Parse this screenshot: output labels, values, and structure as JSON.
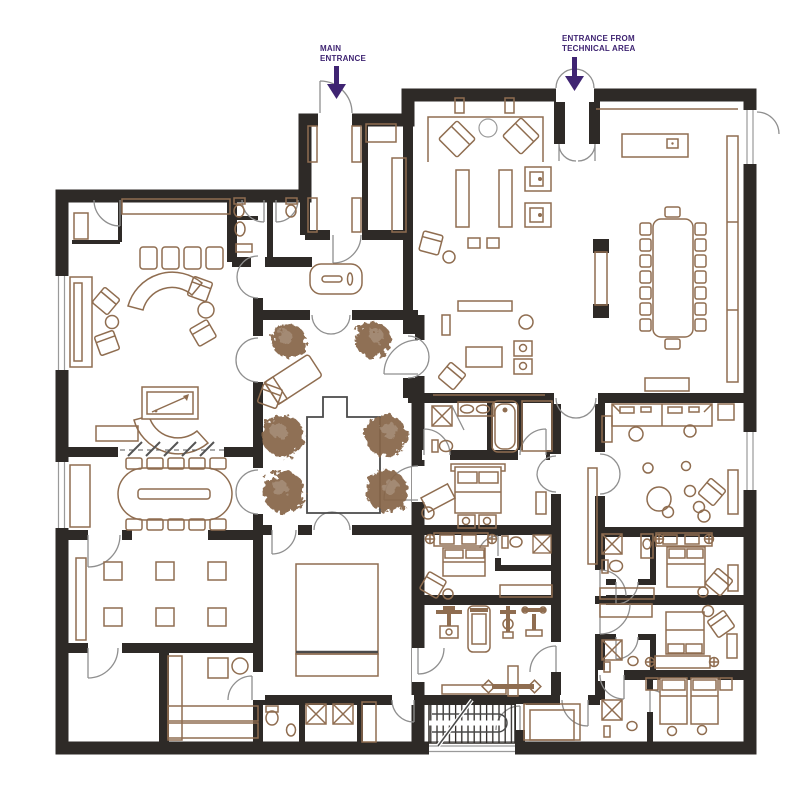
{
  "annotations": {
    "main_entrance": {
      "text": "MAIN\nENTRANCE",
      "arrow_direction": "down"
    },
    "technical_entrance": {
      "text": "ENTRANCE FROM\nTECHNICAL AREA",
      "arrow_direction": "down"
    }
  },
  "colors": {
    "wall": "#2e2a27",
    "furniture": "#8f6d50",
    "tree": "#876649",
    "door": "#8f8f8f",
    "label": "#3f2472",
    "plaza": "#4a4a4a",
    "bg": "#ffffff"
  }
}
